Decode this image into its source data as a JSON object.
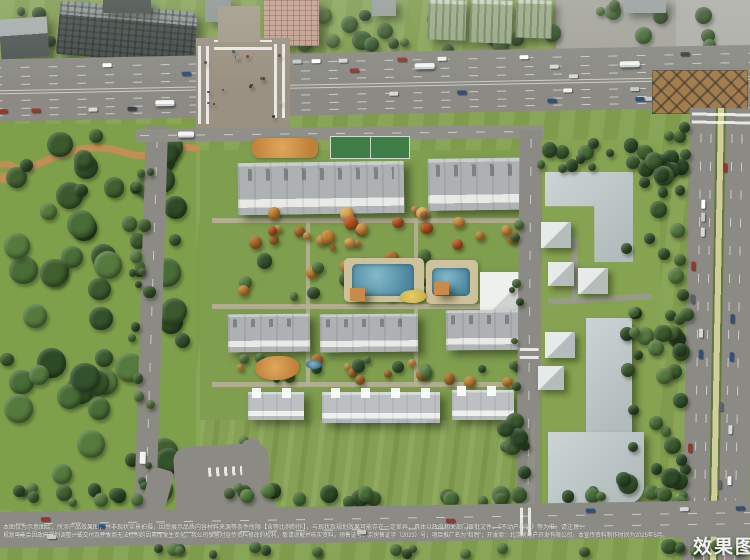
{
  "watermark": {
    "label": "效果图"
  },
  "disclaimer": {
    "line1": "本图仅为示意图绘，所涉产品效果图，并非现状实景拍摄，因受展示品质内容材料来源等条件所限【含等比例制作】，与现状及规划效果可能存在一定差异，具体以政府相关部门审批文件、《不动产权证》等为准。请注意：",
    "line2": "规划可能会因政府规划调整、或交付及开发商无法控制的因素而发生变化。我公司保留对宣传资料修改的权利，敬请谅解并核实资料。预售证号：京房售证字（2023）号；项目推广名为“和煦”；开发商：北京房地产开发有限公司。本宣传资料制作时间为2025年5月。"
  },
  "scene": {
    "colors": {
      "grass": "#83a04e",
      "lawn": "#8fae57",
      "road": "#8b8a84",
      "roof_residential": "#adb1b3",
      "roof_campus": "#b9c3c5",
      "autumn_tree": "#c2812f",
      "pool": "#4d87a0",
      "park_path": "#c28e55",
      "parking_lot": "#a37c4c"
    }
  }
}
